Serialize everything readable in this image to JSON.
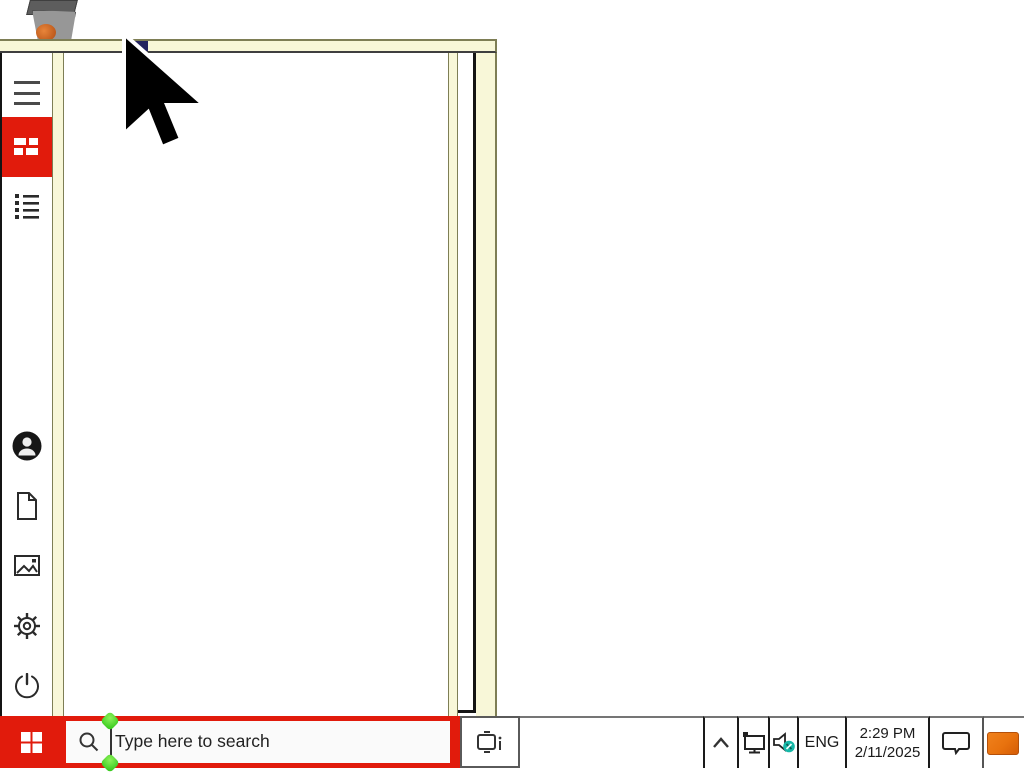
{
  "colors": {
    "accent_red": "#e11b0c",
    "frame_cream": "#f8f7d8",
    "frame_olive": "#7e7e55",
    "handle_green": "#27c212",
    "volume_badge_teal": "#16b8a8",
    "tray_app_orange": "#e8720e"
  },
  "desktop": {
    "icons": [
      "recycle-bin-icon"
    ]
  },
  "start_menu": {
    "nav_items": [
      {
        "id": "menu",
        "icon": "hamburger-icon",
        "active": false
      },
      {
        "id": "pinned-tiles",
        "icon": "tiles-icon",
        "active": true
      },
      {
        "id": "all-apps",
        "icon": "list-icon",
        "active": false
      }
    ],
    "bottom_items": [
      {
        "id": "account",
        "icon": "user-icon"
      },
      {
        "id": "documents",
        "icon": "document-icon"
      },
      {
        "id": "pictures",
        "icon": "pictures-icon"
      },
      {
        "id": "settings",
        "icon": "gear-icon"
      },
      {
        "id": "power",
        "icon": "power-icon"
      }
    ]
  },
  "taskbar": {
    "start_icon": "windows-logo",
    "search": {
      "placeholder": "Type here to search",
      "icon": "search-icon",
      "focused": true
    },
    "task_view_icon": "task-view-icon",
    "tray": {
      "overflow_icon": "chevron-up-icon",
      "network_icon": "ethernet-icon",
      "volume_icon": "speaker-badge-icon",
      "language": "ENG",
      "time": "2:29 PM",
      "date": "2/11/2025",
      "action_center_icon": "notification-icon",
      "app_icon": "orange-app-icon"
    }
  },
  "cursor": {
    "type": "arrow"
  }
}
